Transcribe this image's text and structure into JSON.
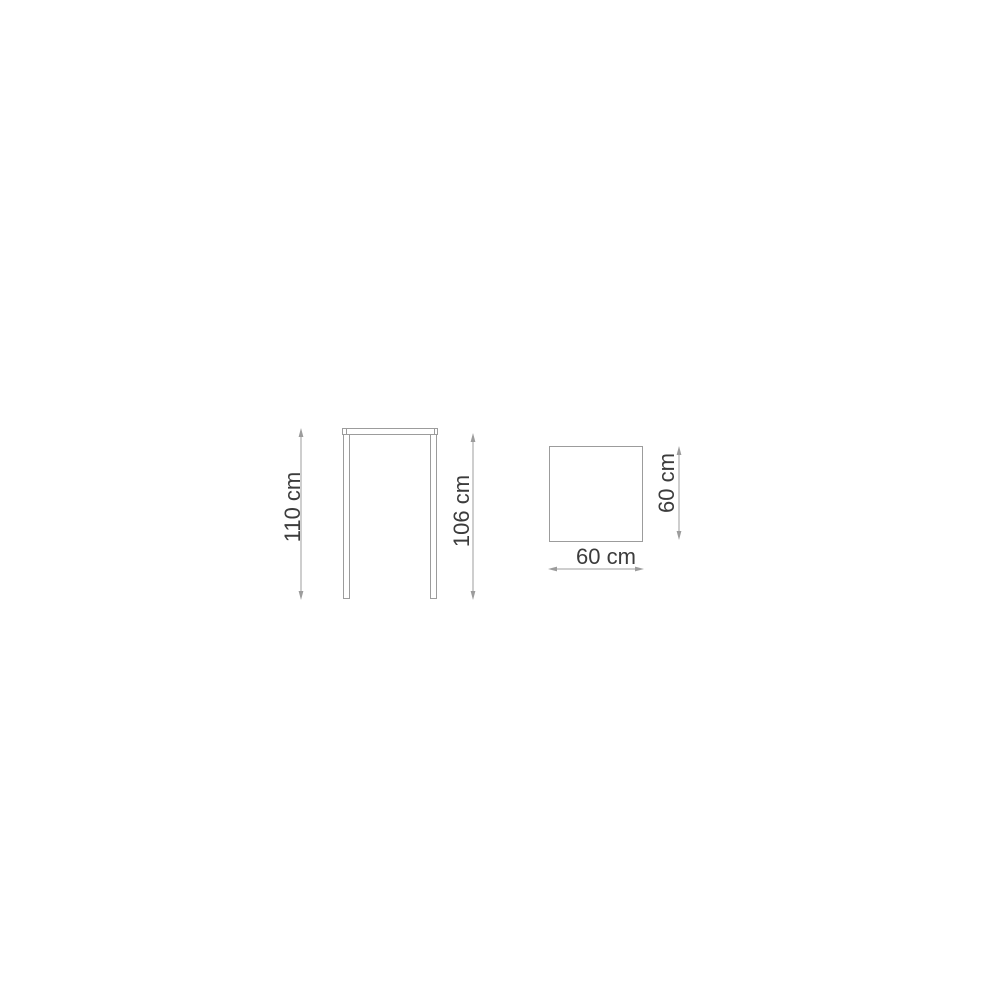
{
  "diagram": {
    "type": "product-dimension-drawing",
    "subject": "bar-table",
    "colors": {
      "background": "#ffffff",
      "line": "#9c9c9c",
      "text": "#3c3c3c"
    },
    "views": {
      "front": {
        "name": "front-view",
        "dimensions": [
          {
            "id": "total-height",
            "label": "110 cm"
          },
          {
            "id": "height-under-top",
            "label": "106 cm"
          }
        ]
      },
      "top": {
        "name": "top-view",
        "dimensions": [
          {
            "id": "width",
            "label": "60 cm"
          },
          {
            "id": "depth",
            "label": "60 cm"
          }
        ]
      }
    }
  }
}
